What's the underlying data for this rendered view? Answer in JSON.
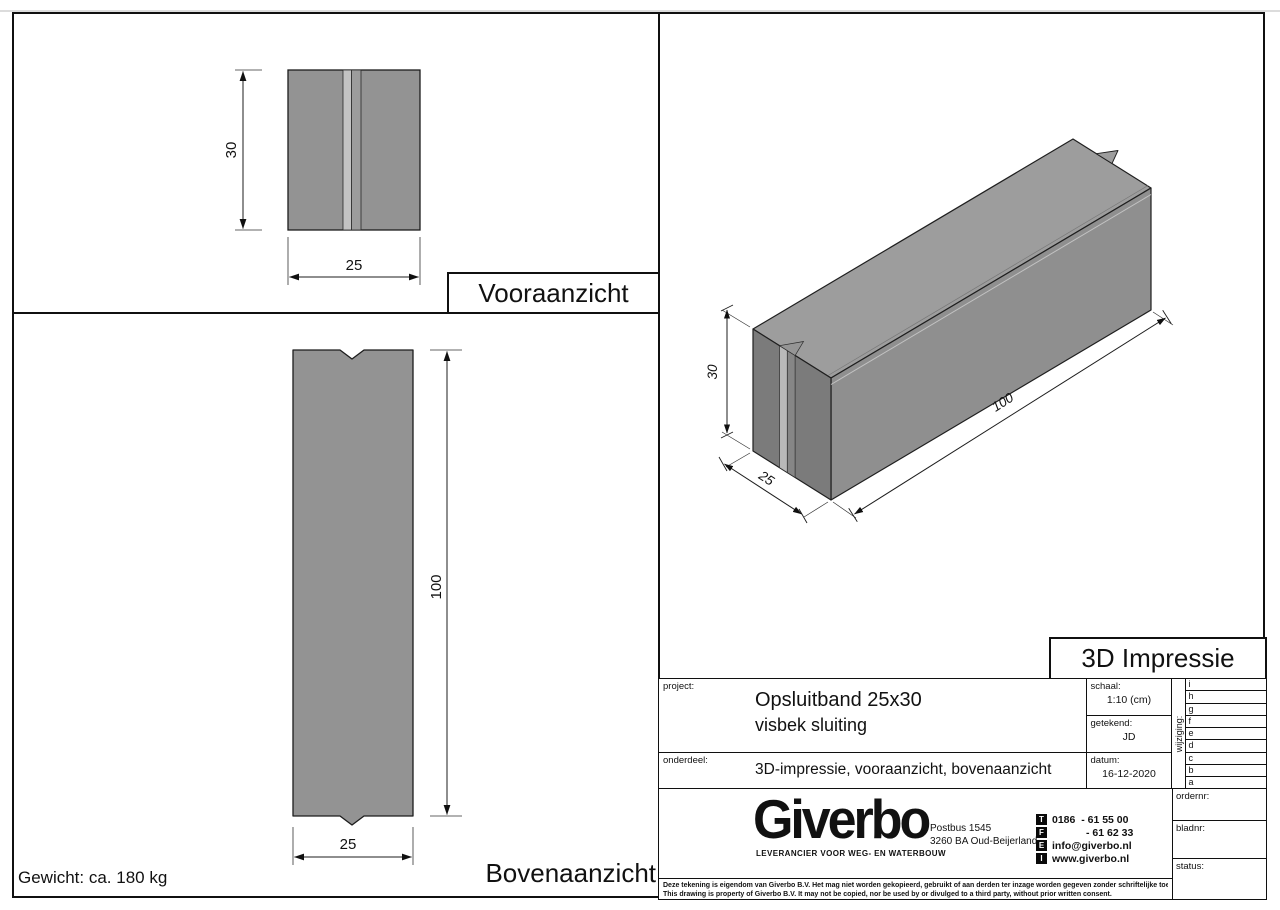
{
  "colors": {
    "body_gray": "#939393",
    "groove_light": "#c3c3c3",
    "groove_mid": "#9c9c9c",
    "iso_top": "#9d9d9d",
    "iso_front": "#8f8f8f",
    "iso_end": "#7b7b7b",
    "line": "#101010"
  },
  "weight_note": "Gewicht: ca. 180 kg",
  "views": {
    "front": {
      "title": "Vooraanzicht",
      "dim_height": "30",
      "dim_width": "25"
    },
    "top": {
      "title": "Bovenaanzicht",
      "dim_length": "100",
      "dim_width": "25"
    },
    "iso": {
      "title": "3D Impressie",
      "dim_height": "30",
      "dim_width": "25",
      "dim_length": "100"
    }
  },
  "titleblock": {
    "project_label": "project:",
    "project_line1": "Opsluitband 25x30",
    "project_line2": "visbek sluiting",
    "onderdeel_label": "onderdeel:",
    "onderdeel_value": "3D-impressie, vooraanzicht, bovenaanzicht",
    "schaal_label": "schaal:",
    "schaal_value": "1:10 (cm)",
    "getekend_label": "getekend:",
    "getekend_value": "JD",
    "datum_label": "datum:",
    "datum_value": "16-12-2020",
    "wijziging_label": "wijziging:",
    "revision_letters": [
      "i",
      "h",
      "g",
      "f",
      "e",
      "d",
      "c",
      "b",
      "a"
    ],
    "ordernr_label": "ordernr:",
    "bladnr_label": "bladnr:",
    "status_label": "status:"
  },
  "company": {
    "name": "Giverbo",
    "tagline": "LEVERANCIER VOOR WEG- EN WATERBOUW",
    "address_line1": "Postbus 1545",
    "address_line2": "3260 BA Oud-Beijerland",
    "contacts": [
      {
        "icon": "T",
        "value": "0186  - 61 55 00"
      },
      {
        "icon": "F",
        "value": "- 61 62 33"
      },
      {
        "icon": "E",
        "value": "info@giverbo.nl"
      },
      {
        "icon": "I",
        "value": "www.giverbo.nl"
      }
    ]
  },
  "disclaimer": {
    "line1": "Deze tekening is eigendom van Giverbo B.V. Het mag niet worden gekopieerd, gebruikt of aan derden ter inzage worden gegeven zonder schriftelijke toestemming vooraf.",
    "line2": "This drawing is property of Giverbo B.V. It may not be copied, nor be used by or divulged to a third party, without prior written consent."
  }
}
